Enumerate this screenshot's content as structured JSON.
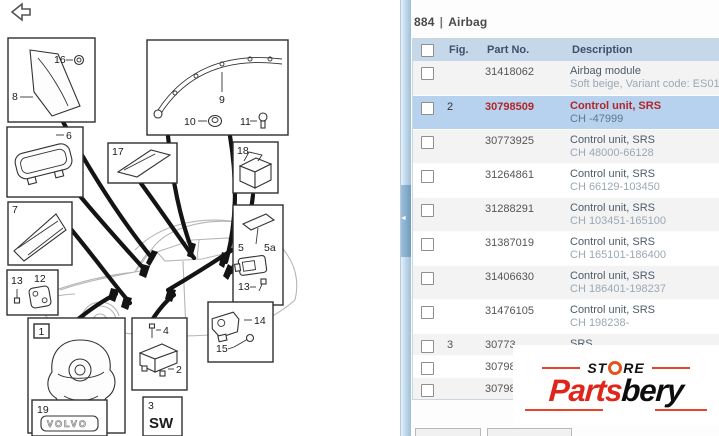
{
  "header": {
    "section_code": "884",
    "separator": "|",
    "section_title": "Airbag"
  },
  "colors": {
    "accent_red": "#b2252a",
    "selected_row_bg": "#b6d2ef",
    "table_header_bg": "#c5d8e9",
    "logo_red": "#e0251b",
    "logo_orange": "#e2541f",
    "logo_black": "#0d0d0d"
  },
  "table": {
    "headers": {
      "fig": "Fig.",
      "part_no": "Part No.",
      "description": "Description"
    },
    "rows": [
      {
        "fig": "",
        "part": "31418062",
        "desc": "Airbag module",
        "sub": "Soft beige, Variant code: ES01 and",
        "selected": false,
        "red": false
      },
      {
        "fig": "2",
        "part": "30798509",
        "desc": "Control unit, SRS",
        "sub": "CH -47999",
        "selected": true,
        "red": true
      },
      {
        "fig": "",
        "part": "30773925",
        "desc": "Control unit, SRS",
        "sub": "CH 48000-66128",
        "selected": false,
        "red": false
      },
      {
        "fig": "",
        "part": "31264861",
        "desc": "Control unit, SRS",
        "sub": "CH 66129-103450",
        "selected": false,
        "red": false
      },
      {
        "fig": "",
        "part": "31288291",
        "desc": "Control unit, SRS",
        "sub": "CH 103451-165100",
        "selected": false,
        "red": false
      },
      {
        "fig": "",
        "part": "31387019",
        "desc": "Control unit, SRS",
        "sub": "CH 165101-186400",
        "selected": false,
        "red": false
      },
      {
        "fig": "",
        "part": "31406630",
        "desc": "Control unit, SRS",
        "sub": "CH 186401-198237",
        "selected": false,
        "red": false
      },
      {
        "fig": "",
        "part": "31476105",
        "desc": "Control unit, SRS",
        "sub": "CH 198238-",
        "selected": false,
        "red": false
      },
      {
        "fig": "3",
        "part": "30773",
        "desc": "SRS",
        "sub": "",
        "selected": false,
        "red": false
      },
      {
        "fig": "",
        "part": "30798",
        "desc": "",
        "sub": "",
        "selected": false,
        "red": false
      },
      {
        "fig": "",
        "part": "30798",
        "desc": "",
        "sub": "",
        "selected": false,
        "red": false
      }
    ]
  },
  "diagram": {
    "labels": {
      "n1": "1",
      "n2": "2",
      "n3": "3",
      "n4": "4",
      "n5": "5",
      "n5a": "5a",
      "n6": "6",
      "n7": "7",
      "n8": "8",
      "n9": "9",
      "n10": "10",
      "n11": "11",
      "n12": "12",
      "n13a": "13",
      "n13b": "13",
      "n14": "14",
      "n15": "15",
      "n16": "16",
      "n17": "17",
      "n18": "18",
      "n19": "19"
    },
    "texts": {
      "sw": "SW",
      "volvo": "VOLVO"
    }
  },
  "logo": {
    "store_st": "ST",
    "store_re": "RE",
    "parts": "Parts",
    "bery": "bery"
  }
}
